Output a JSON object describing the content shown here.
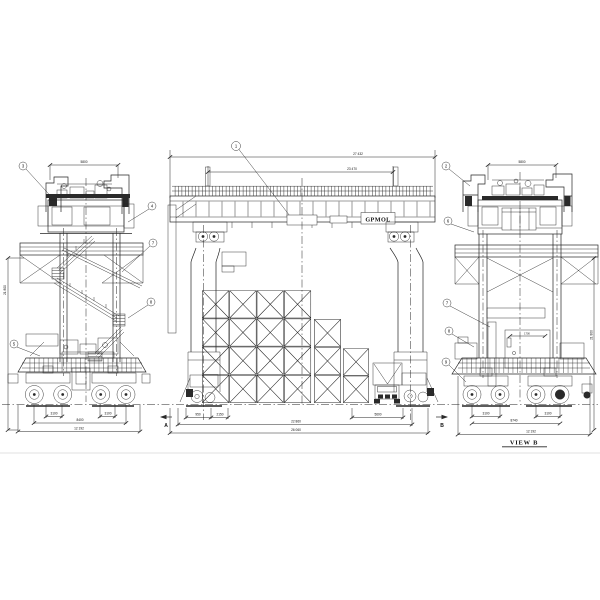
{
  "labels": {
    "brand_plate": "GPMOL",
    "view_b_title": "VIEW B",
    "section_a": "A",
    "section_b": "B"
  },
  "balloons": {
    "center": "1",
    "left_top": "3",
    "left_r1": "4",
    "left_r2": "7",
    "left_r3": "8",
    "left_bottom": "5",
    "right_1": "2",
    "right_2": "6",
    "right_3": "7",
    "right_4": "8",
    "right_5": "9"
  },
  "dims": {
    "left_top": "5800",
    "left_height": "21 800",
    "left_wb1": "3100",
    "left_wb2": "3100",
    "left_mid": "8400",
    "left_base": "12 192",
    "center_outer": "27 432",
    "center_inner": "23 470",
    "center_s1": "950",
    "center_s2": "2150",
    "center_s3": "5600",
    "center_mid": "22 860",
    "center_base": "26 060",
    "right_top": "5800",
    "right_axle1": "3100",
    "right_axle2": "3100",
    "right_mid": "8740",
    "right_base": "12 192",
    "right_height": "21 800",
    "room": "1700"
  }
}
